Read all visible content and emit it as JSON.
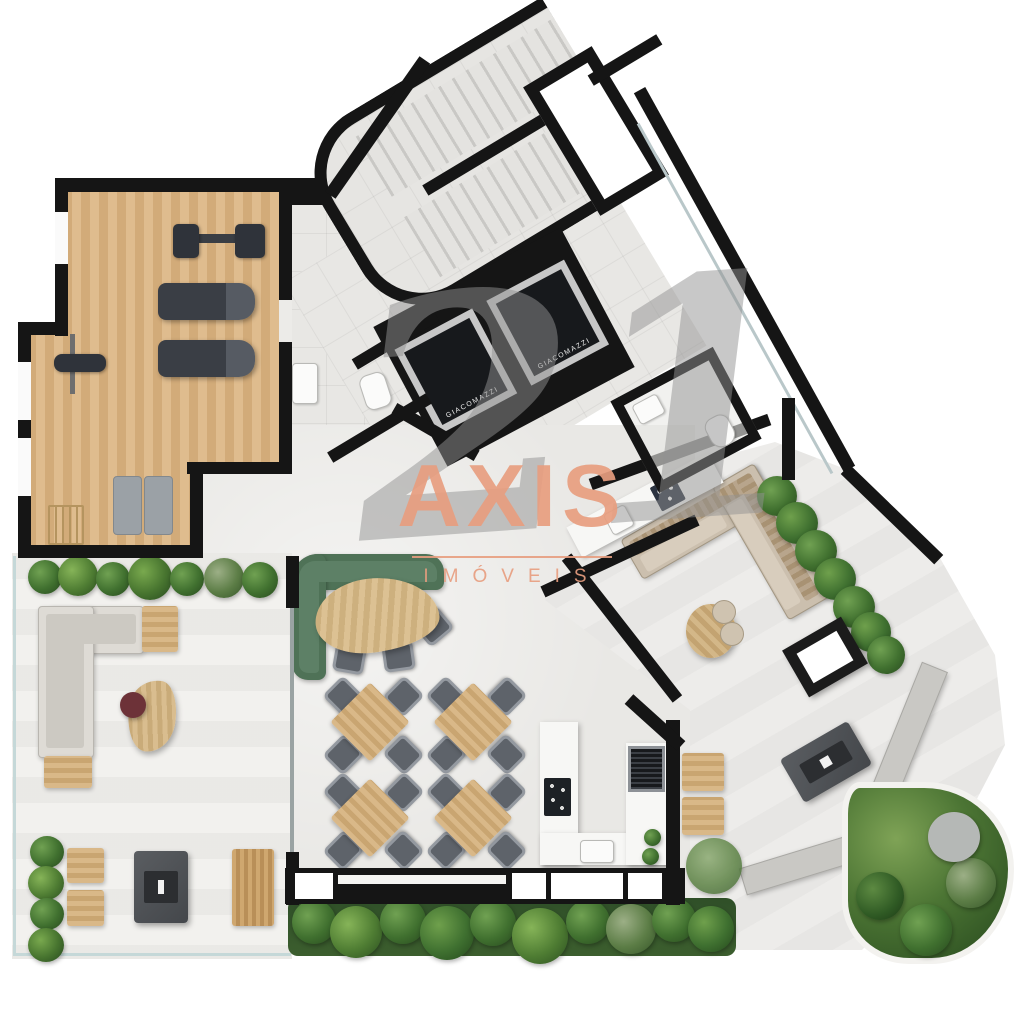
{
  "meta": {
    "kind": "architectural-floor-plan-render",
    "view": "top-down amenities floor"
  },
  "watermark": {
    "numeral": "21",
    "brand": "AXIS",
    "subtitle": "IMÓVEIS",
    "brand_color": "#e79d7f",
    "numeral_color": "#9a9a9a"
  },
  "elevators": {
    "label": "GIACOMAZZI",
    "count": 2
  },
  "palette": {
    "wall_black": "#151515",
    "tile_floor": "#e8e7e4",
    "gym_wood_floor": "#d8b383",
    "terrace_floor": "#f2f1ee",
    "right_terrace_floor": "#edecea",
    "banquette_green": "#4f7257",
    "table_wood": "#d5b485",
    "plant_green": "#40702f",
    "counter_white": "#f7f7f5",
    "equipment_dark": "#33373d",
    "glass_railing": "#c5d8d8",
    "accent_red": "#6d3238"
  },
  "areas": [
    "gym",
    "stair-core",
    "elevator-lobby",
    "hall",
    "wc",
    "lounge-dining",
    "kitchen",
    "left-terrace",
    "bbq-terrace",
    "right-terrace",
    "garden-beds"
  ],
  "furniture_inventory": [
    "cable-machine",
    "treadmill",
    "treadmill",
    "bench-press",
    "wall-bars",
    "exercise-mat",
    "exercise-mat",
    "curved-green-banquette",
    "organic-wood-table",
    "dining-table-x4-with-chairs",
    "kitchen-u-counter",
    "cooktop",
    "grill",
    "sink",
    "l-shaped-outdoor-sofa",
    "organic-coffee-table",
    "square-wood-tables",
    "fire-pit-table",
    "wood-bench",
    "beige-l-sofa",
    "round-coffee-table-with-poufs",
    "tv-screen",
    "l-shaped-stone-bench",
    "fire-pit-table",
    "hedge",
    "planters",
    "stepping-stone"
  ]
}
